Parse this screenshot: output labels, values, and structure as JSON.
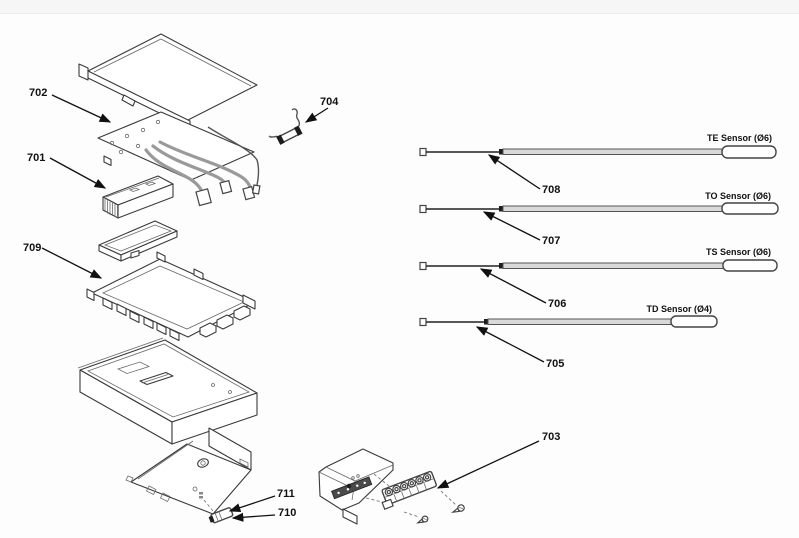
{
  "figure": {
    "kind": "exploded-parts-diagram",
    "colors": {
      "ink": "#1d1d1d",
      "wire_gray": "#9a9a9a",
      "tube_gray": "#d9d9d9",
      "background": "#fdfdfd"
    }
  },
  "callouts": {
    "701": "701",
    "702": "702",
    "703": "703",
    "704": "704",
    "705": "705",
    "706": "706",
    "707": "707",
    "708": "708",
    "709": "709",
    "710": "710",
    "711": "711"
  },
  "sensors": [
    {
      "label": "TE Sensor (Ø6)"
    },
    {
      "label": "TO Sensor (Ø6)"
    },
    {
      "label": "TS Sensor (Ø6)"
    },
    {
      "label": "TD Sensor (Ø4)"
    }
  ]
}
